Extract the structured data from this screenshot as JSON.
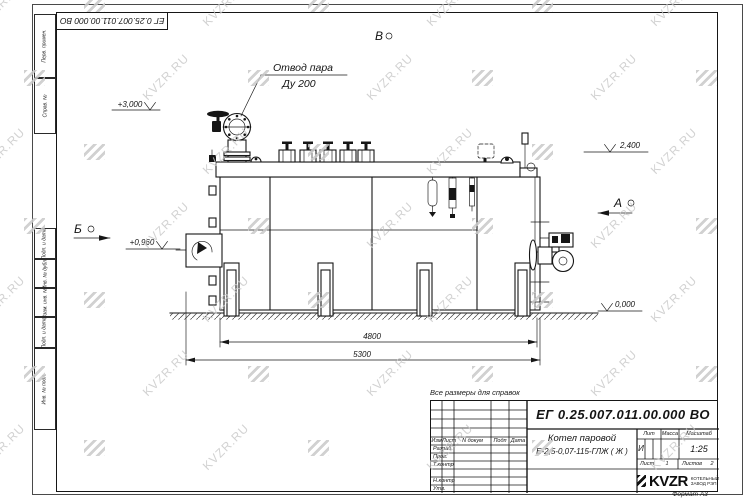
{
  "watermark": {
    "text": "KVZR.RU"
  },
  "colors": {
    "line": "#161616",
    "watermark": "#c7c7c7"
  },
  "stamp_top": {
    "doc_number": "ЕГ 0.25.007.011.00.000  ВО"
  },
  "margin_columns": [
    "Перв. примен.",
    "Справ. №",
    "Подп. и дата",
    "Инв. № дубл.",
    "Взам. инв. №",
    "Подп. и дата",
    "Инв. № подл."
  ],
  "note": "Все размеры для справок",
  "drawing": {
    "callout_line1": "Отвод пара",
    "callout_line2": "Ду 200",
    "elev_top": "+3,000",
    "elev_drum": "2,400",
    "elev_burner": "+0,960",
    "elev_ground": "0,000",
    "view_b": "Б",
    "view_v": "В",
    "view_a": "А",
    "dim_inner": "4800",
    "dim_overall": "5300"
  },
  "title_block": {
    "doc_number": "ЕГ 0.25.007.011.00.000  ВО",
    "product_name_line1": "Котел паровой",
    "product_name_line2": "Е-2,5-0,07-115-ГЛЖ ( Ж )",
    "col_izm": "Изм",
    "col_list": "Лист",
    "col_ndokum": "N докум",
    "col_podp": "Подп",
    "col_data": "Дата",
    "rows": [
      "Разраб.",
      "Пров.",
      "Т.контр",
      "",
      "Н.контр",
      "Утв."
    ],
    "lit_label": "Лит",
    "lit_value": "И",
    "massa_label": "Масса",
    "masshtab_label": "Масштаб",
    "masshtab_value": "1:25",
    "list_label": "Лист",
    "list_value": "1",
    "listov_label": "Листов",
    "listov_value": "2",
    "logo_text": "KVZR",
    "logo_sub_line1": "КОТЕЛЬНЫЙ",
    "logo_sub_line2": "ЗАВОД РЭП",
    "format_label": "Формат А3"
  }
}
